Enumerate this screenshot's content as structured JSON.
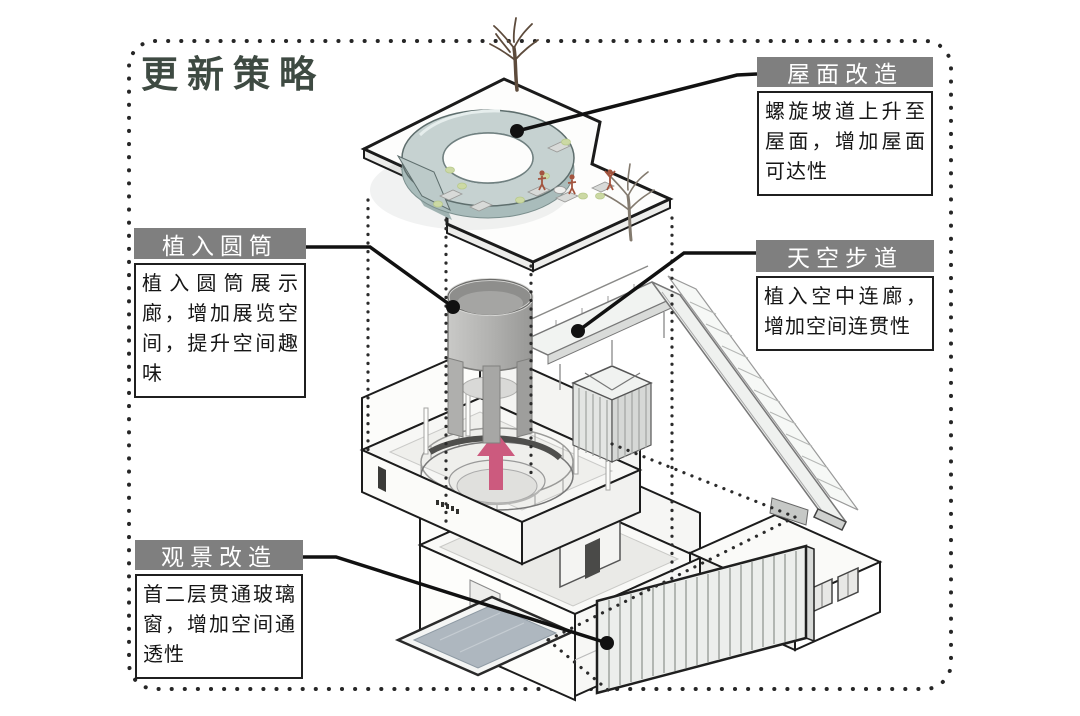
{
  "figure": {
    "title": "更新策略",
    "border_style": "dotted-rounded-rectangle"
  },
  "callouts": {
    "roof": {
      "header": "屋面改造",
      "body": "螺旋坡道上升至屋面，增加屋面可达性"
    },
    "cylinder": {
      "header": "植入圆筒",
      "body": "植入圆筒展示廊，增加展览空间，提升空间趣味"
    },
    "skywalk": {
      "header": "天空步道",
      "body": "植入空中连廊，增加空间连贯性"
    },
    "viewing": {
      "header": "观景改造",
      "body": "首二层贯通玻璃窗，增加空间通透性"
    }
  },
  "diagram": {
    "parts": [
      "roof-slab",
      "spiral-ramp",
      "bare-tree",
      "roof-furniture",
      "cylinder-gallery",
      "sky-walkway",
      "striped-hut",
      "atrium-floor",
      "up-arrow",
      "ground-floor",
      "pool",
      "striped-glass-panel",
      "projection-guides",
      "leader-dots"
    ]
  },
  "colors": {
    "title_text": "#3e4a42",
    "callout_header_bg": "#7f7f7f",
    "callout_header_text": "#ffffff",
    "callout_body_border": "#1f1f1f",
    "leader_line": "#111111",
    "ramp": "#c6d2d1",
    "cylinder": "#b2b2b0",
    "pool_water": "#aeb7bf",
    "arrow_pink": "#cc5a7e",
    "line_work": "#1c1c1c"
  }
}
